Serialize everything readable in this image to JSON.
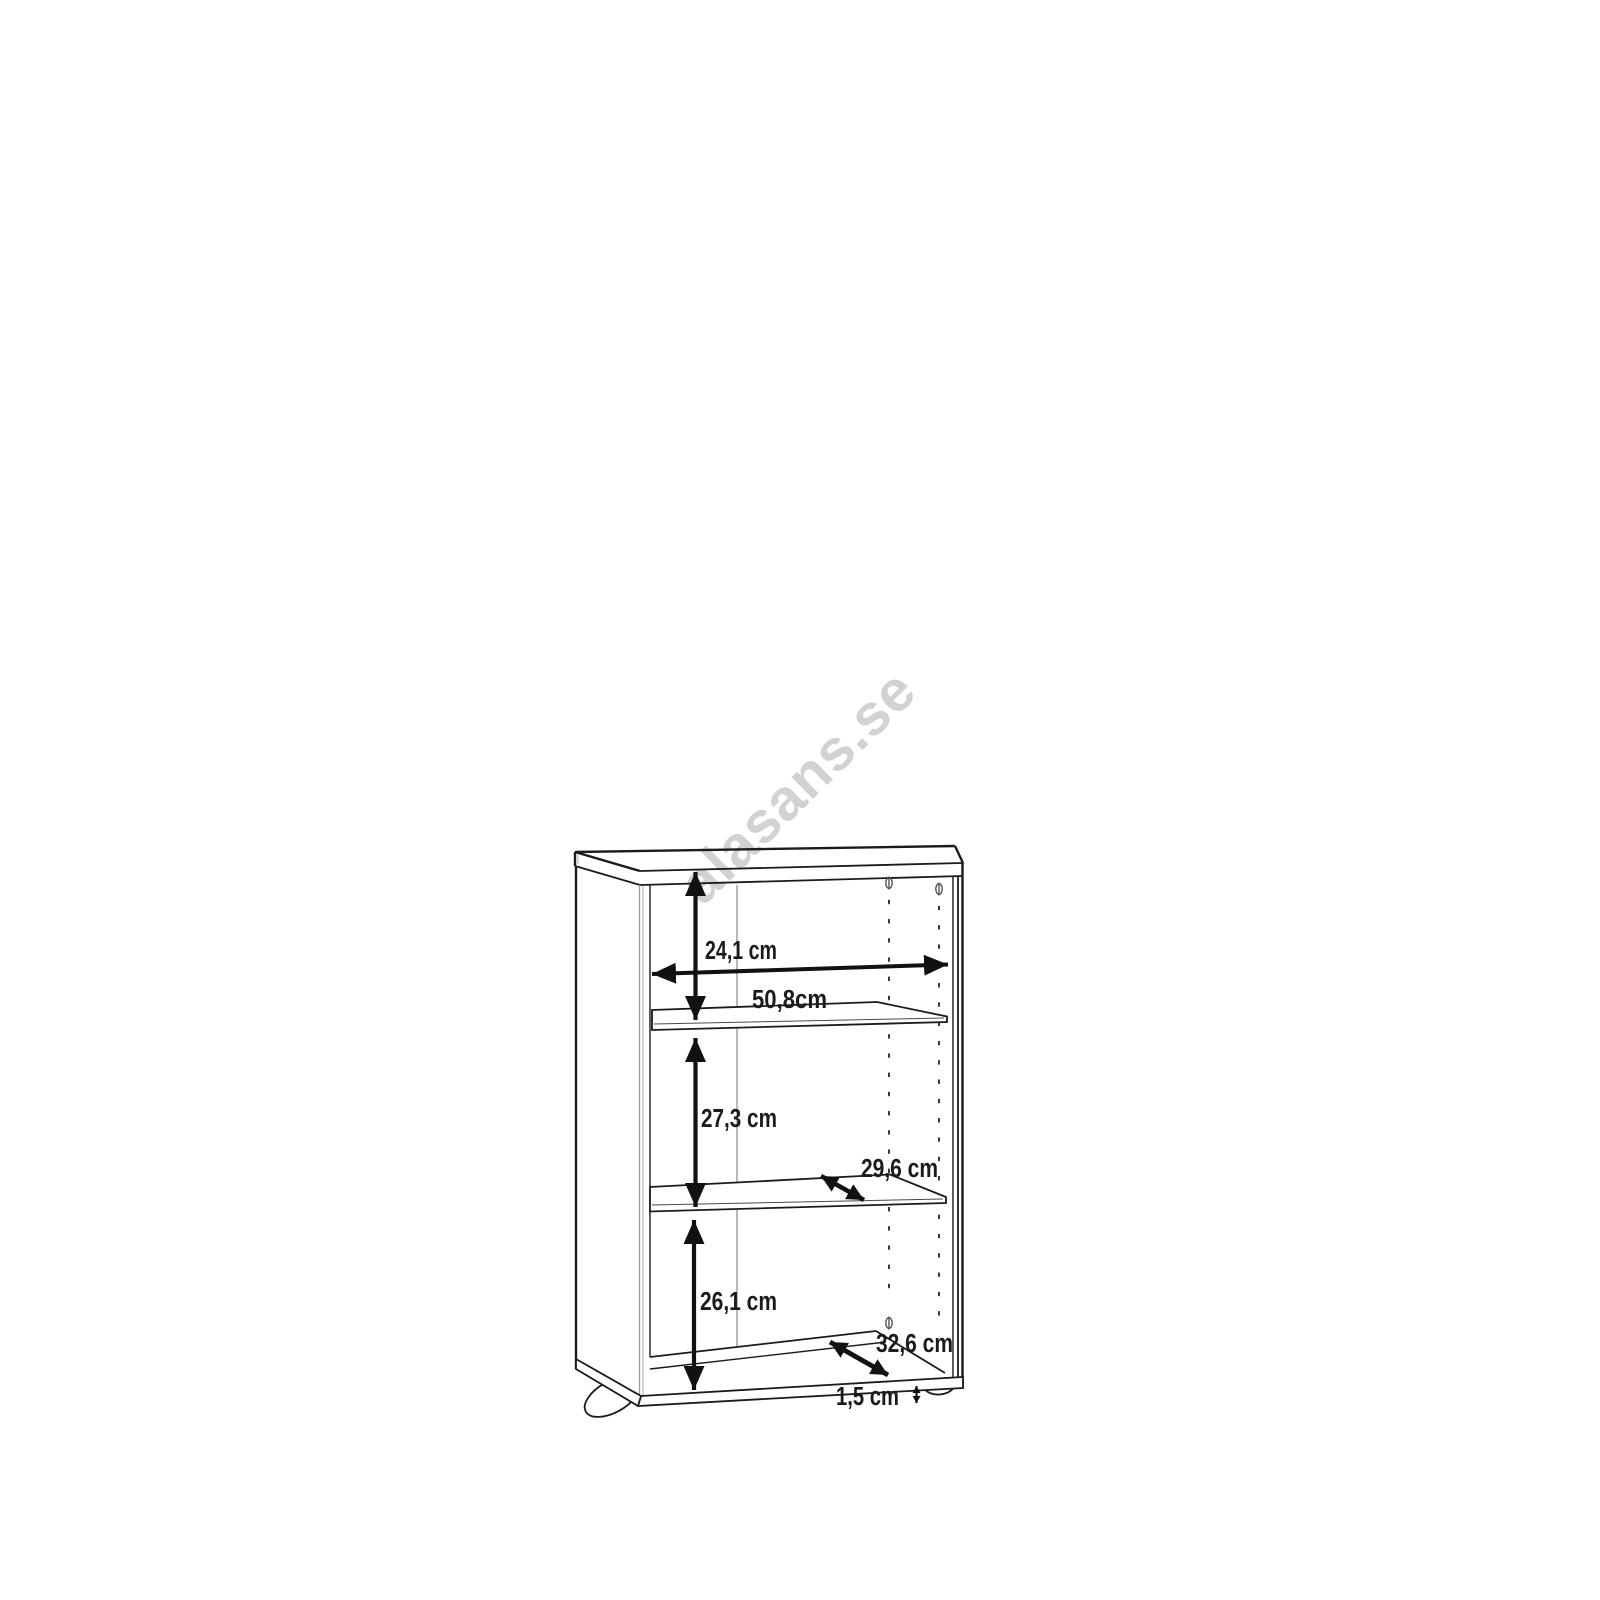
{
  "watermark": {
    "text": "alasans.se",
    "color": "#d2d2d2"
  },
  "diagram": {
    "type": "furniture-dimension-drawing",
    "subject": "bookcase with two adjustable shelves, right side pin-hole columns and plinth feet"
  },
  "dimensions": {
    "top_compartment_height": "24,1 cm",
    "inner_width": "50,8cm",
    "middle_compartment_height": "27,3 cm",
    "shelf_depth": "29,6 cm",
    "bottom_compartment_height": "26,1 cm",
    "bottom_panel_depth": "32,6 cm",
    "plinth_thickness": "1,5 cm"
  },
  "colors": {
    "line": "#1b1b1b",
    "dimension": "#111111",
    "seam_gray": "#9d9d9d",
    "watermark_gray": "#d2d2d2",
    "background": "#ffffff"
  }
}
